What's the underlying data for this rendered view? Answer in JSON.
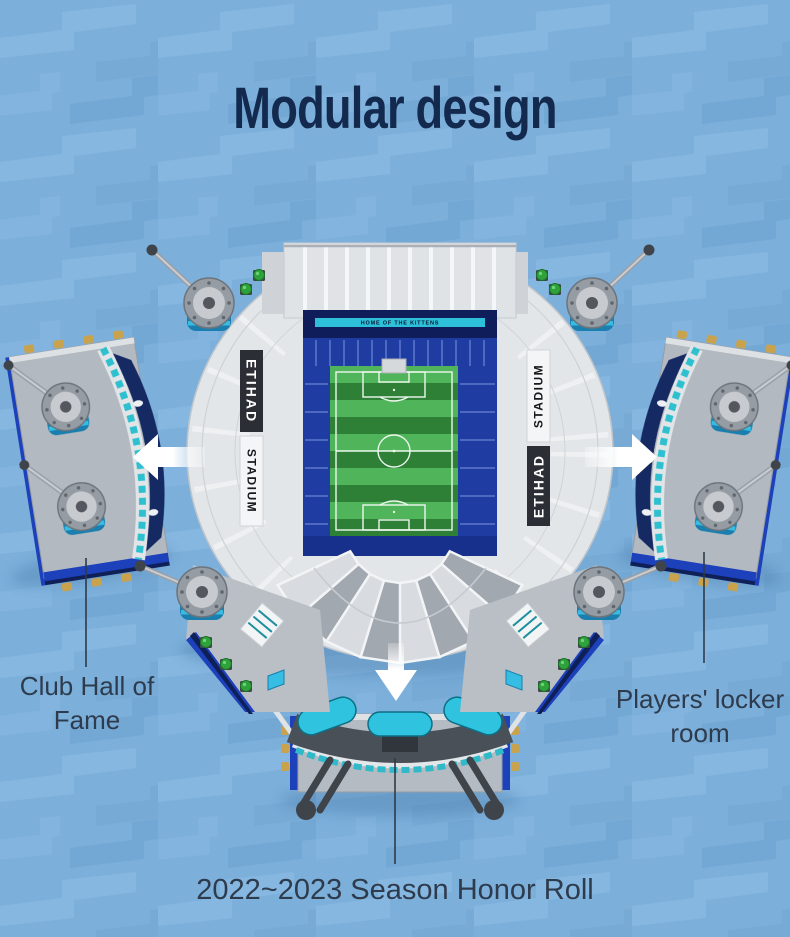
{
  "title": "Modular design",
  "stadium": {
    "top_banner": "HOME OF THE KITTENS",
    "brand_primary": "ETIHAD",
    "brand_secondary": "STADIUM"
  },
  "callouts": {
    "left": "Club Hall of Fame",
    "right": "Players' locker room",
    "bottom": "2022~2023 Season Honor Roll"
  },
  "icons": {
    "arrow_left": "arrow-left-icon",
    "arrow_right": "arrow-right-icon",
    "arrow_down": "arrow-down-icon"
  },
  "colors": {
    "background": "#7cb0db",
    "pattern_light": "#85b7e1",
    "pattern_dark": "#74a8d4",
    "title_navy": "#132a4e",
    "label_slate": "#2e3b4d",
    "seat_blue": "#1e3ca2",
    "navy_band": "#0f1e5a",
    "accent_cyan": "#2dc0d8",
    "tower_cyan": "#35bde4",
    "pitch_green_light": "#4fb45a",
    "pitch_green_dark": "#2f8037",
    "structure_white": "#e6e9ec",
    "platform_gray": "#b3b9c0",
    "trim_blue": "#1c41bb"
  }
}
